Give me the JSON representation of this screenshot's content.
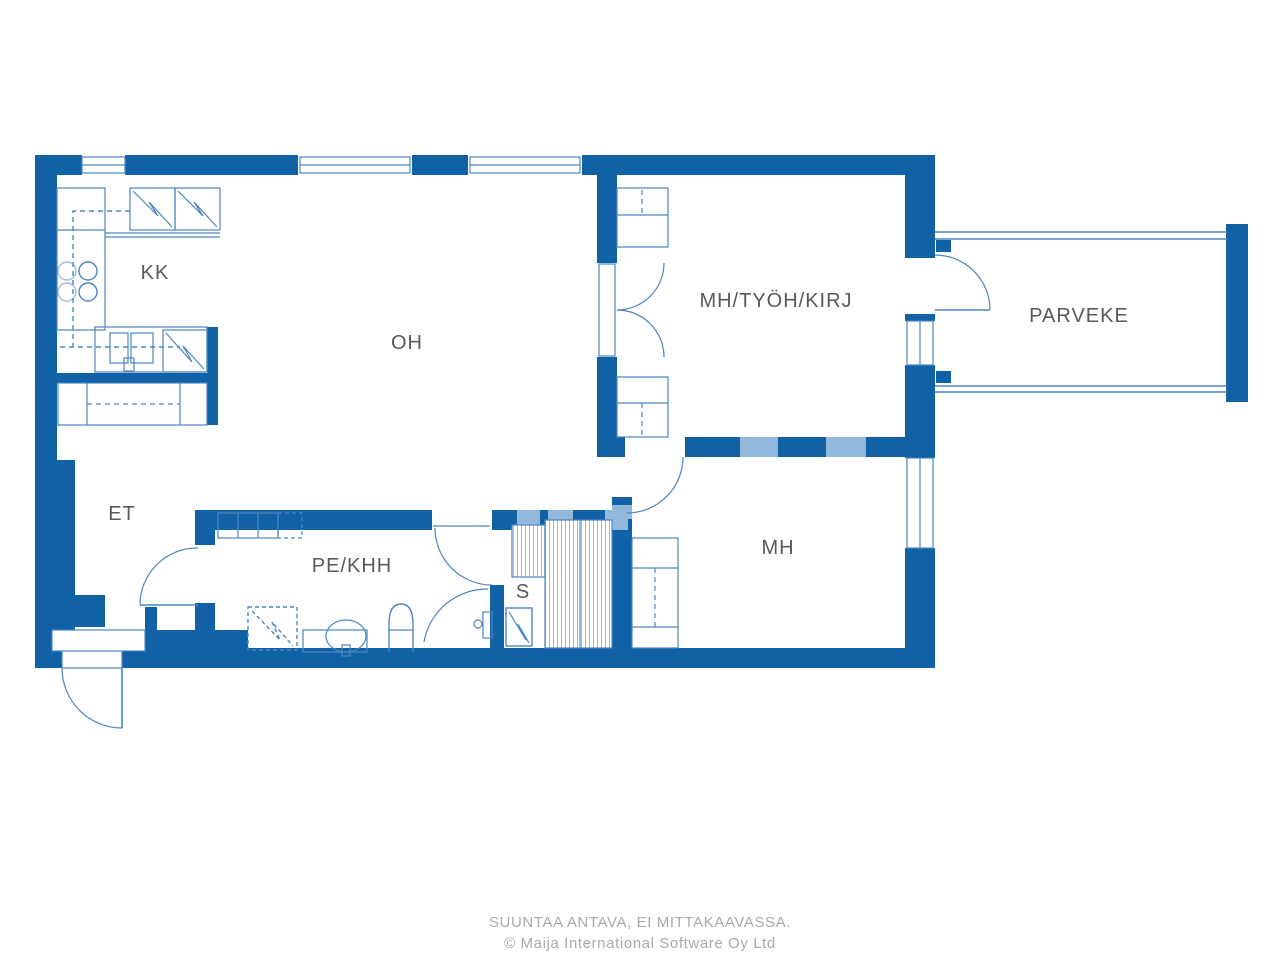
{
  "footer": {
    "line1": "SUUNTAA ANTAVA, EI MITTAKAAVASSA.",
    "line2": "© Maija International Software Oy Ltd"
  },
  "rooms": {
    "kitchen": {
      "label": "KK"
    },
    "living": {
      "label": "OH"
    },
    "entry": {
      "label": "ET"
    },
    "utility": {
      "label": "PE/KHH"
    },
    "sauna": {
      "label": "S"
    },
    "bedroom": {
      "label": "MH"
    },
    "multi": {
      "label": "MH/TYÖH/KIRJ"
    },
    "balcony": {
      "label": "PARVEKE"
    }
  },
  "colors": {
    "wall": "#1161A7",
    "furniture": "#4C86BE",
    "bench_hatch": "#9AA7B4",
    "label": "#58595B",
    "footer": "#A9A9AB",
    "watermark": "#92B8DB"
  }
}
